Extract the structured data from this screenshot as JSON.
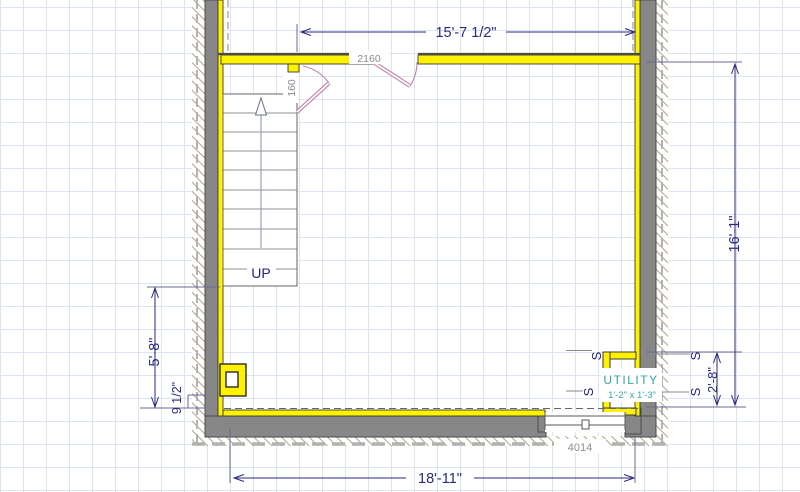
{
  "dimensions": {
    "top": "15'-7 1/2\"",
    "right": "16'-1\"",
    "right_inner": "2'-8\"",
    "left": "5'-8\"",
    "left_inner": "9 1/2\"",
    "bottom": "18'-11\""
  },
  "labels": {
    "door_top": "2160",
    "door_stair": "160",
    "window": "4014",
    "stair_direction": "UP",
    "utility_name": "UTILITY",
    "utility_size": "1'-2\" x 1'-3\"",
    "switch_symbol": "S"
  },
  "colors": {
    "selected_wall_yellow": "#fff200",
    "wall_gray": "#878787",
    "dimension_navy": "#2a2a7e",
    "door_swing_pink": "#bf84ad",
    "utility_teal": "#35a5a5",
    "grid": "#dce3f1",
    "hatch": "#b4a58d",
    "footing_dash_gray": "#b2b2b2"
  }
}
